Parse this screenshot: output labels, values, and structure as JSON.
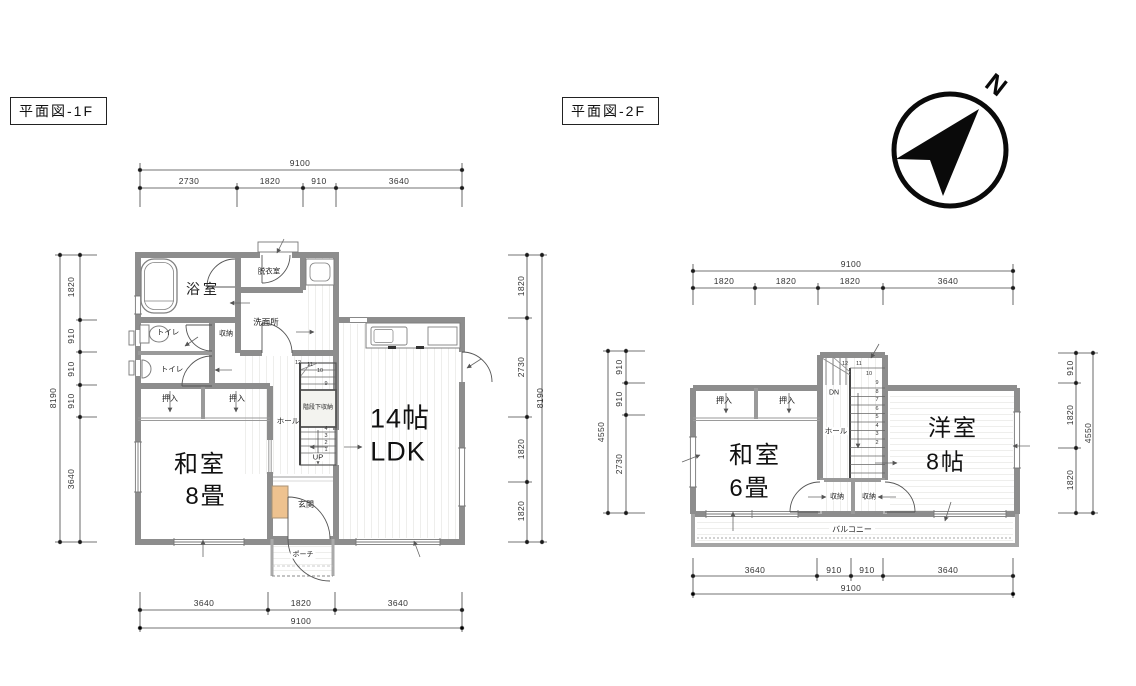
{
  "titles": {
    "f1": "平面図-1F",
    "f2": "平面図-2F"
  },
  "compass": {
    "n": "N"
  },
  "f1": {
    "rooms": {
      "bath": "浴室",
      "dressing": "脱衣室",
      "washroom": "洗面所",
      "toilet1": "トイレ",
      "toilet2": "トイレ",
      "storage": "収納",
      "closet1": "押入",
      "closet2": "押入",
      "washitsu_line1": "和室",
      "washitsu_line2": "8畳",
      "hall": "ホール",
      "under_stair": "階段下収納",
      "up": "UP",
      "ldk_line1": "14帖",
      "ldk_line2": "LDK",
      "entrance": "玄関",
      "porch": "ポーチ"
    },
    "stair_numbers": [
      "12",
      "11",
      "10",
      "9",
      "4",
      "3",
      "2",
      "1"
    ],
    "dims": {
      "top_total": "9100",
      "top": [
        "2730",
        "1820",
        "910",
        "3640"
      ],
      "left_total": "8190",
      "left": [
        "1820",
        "910",
        "910",
        "910",
        "3640"
      ],
      "right_total": "8190",
      "right": [
        "1820",
        "2730",
        "1820",
        "1820"
      ],
      "bottom_total": "9100",
      "bottom": [
        "3640",
        "1820",
        "3640"
      ]
    }
  },
  "f2": {
    "rooms": {
      "closet1": "押入",
      "closet2": "押入",
      "washitsu_line1": "和室",
      "washitsu_line2": "6畳",
      "hall": "ホール",
      "dn": "DN",
      "storage1": "収納",
      "storage2": "収納",
      "yoshitsu_line1": "洋室",
      "yoshitsu_line2": "8帖",
      "balcony": "バルコニー"
    },
    "stair_numbers": [
      "12",
      "11",
      "10",
      "9",
      "8",
      "7",
      "6",
      "5",
      "4",
      "3",
      "2"
    ],
    "dims": {
      "top_total": "9100",
      "top": [
        "1820",
        "1820",
        "1820",
        "3640"
      ],
      "left_total": "4550",
      "left": [
        "910",
        "910",
        "2730"
      ],
      "right_total": "4550",
      "right": [
        "910",
        "1820",
        "1820"
      ],
      "bottom_total": "9100",
      "bottom": [
        "3640",
        "910",
        "910",
        "3640"
      ]
    }
  }
}
